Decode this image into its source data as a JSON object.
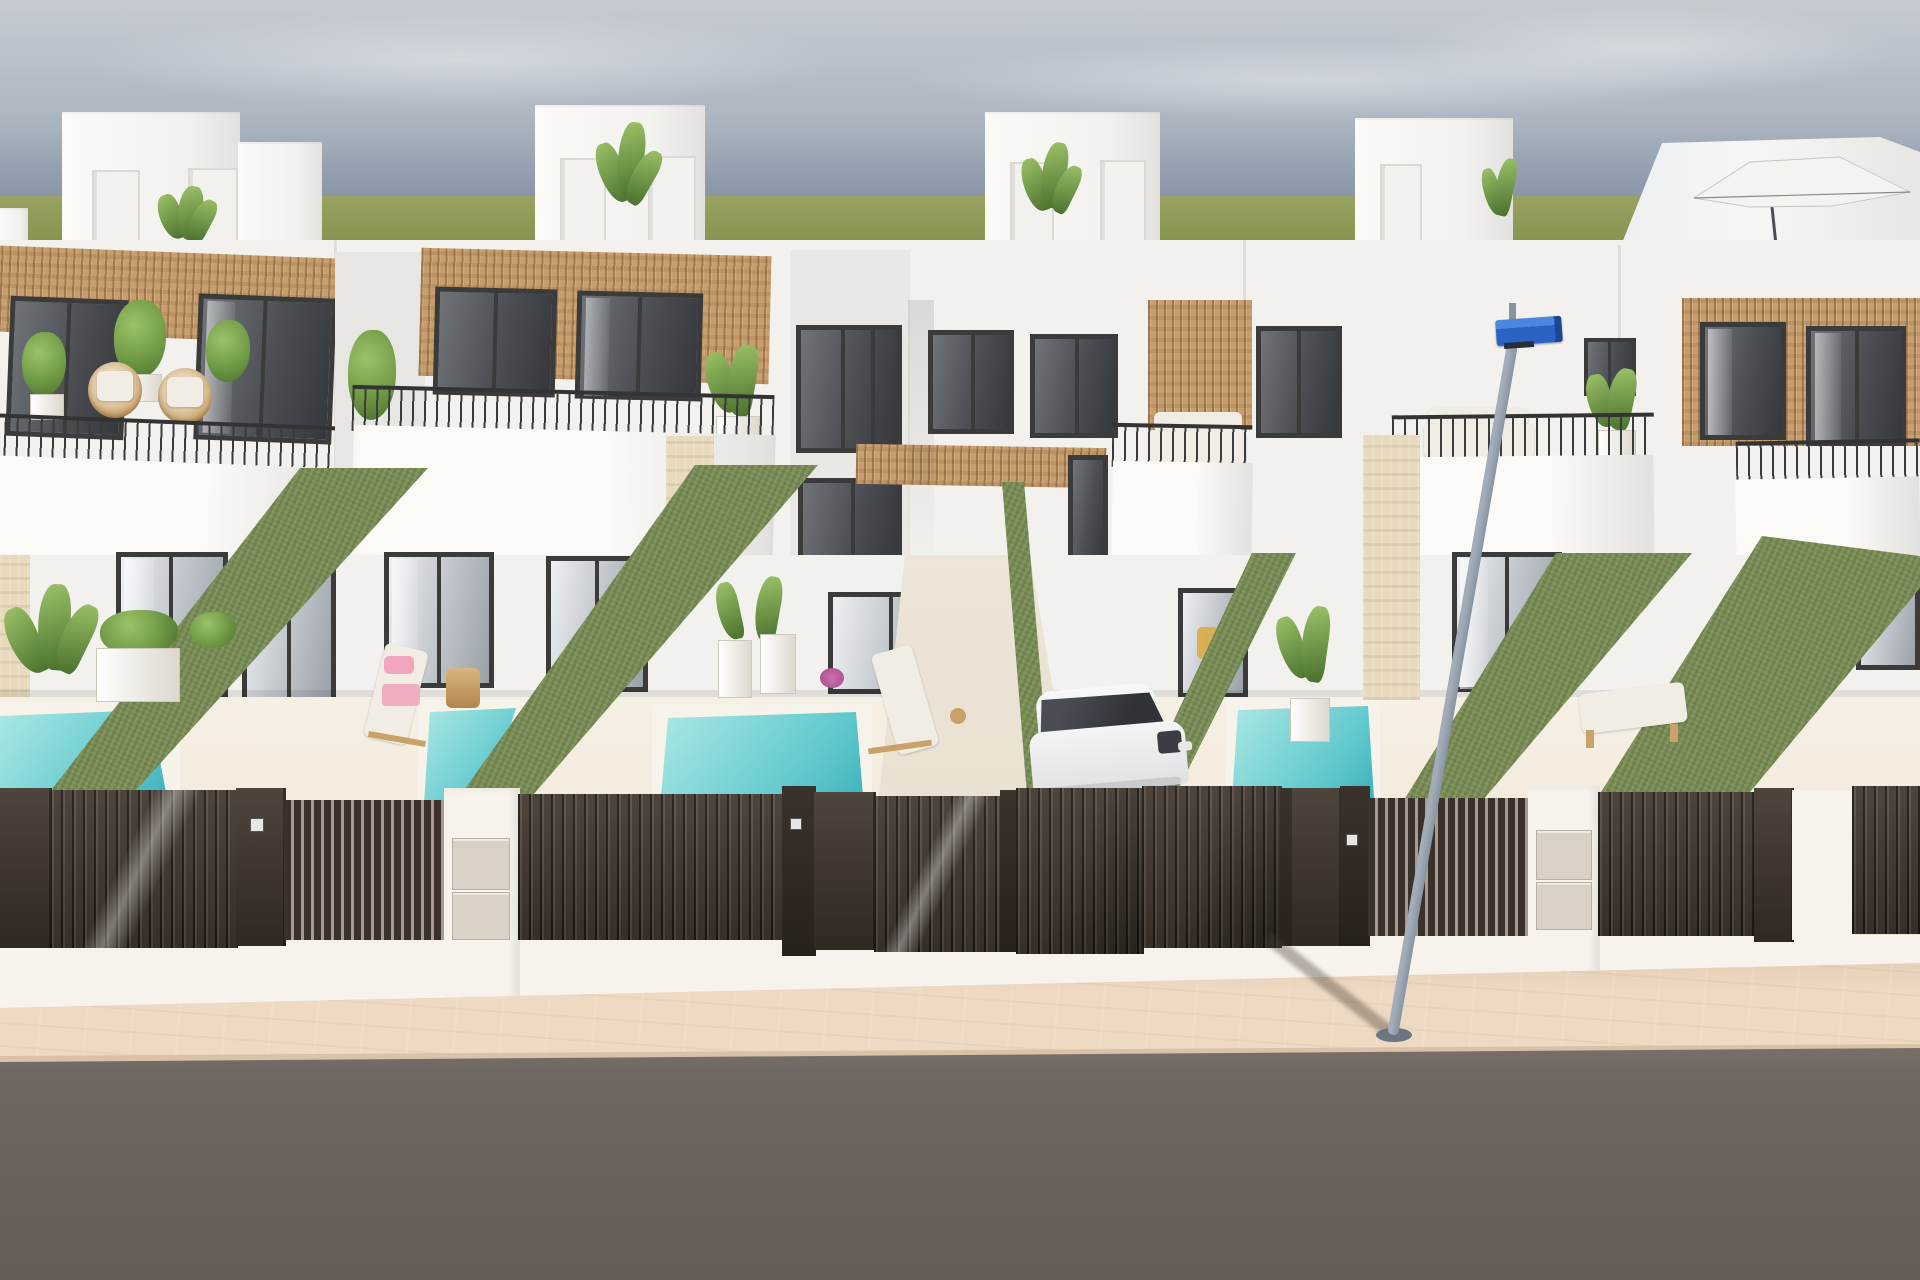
{
  "scene": {
    "type": "architectural-3d-render",
    "description": "Exterior daylight render of a row of modern two-storey white villas with rooftop terraces, wood-slat facade accents, black-framed glazing, private plunge pools, green hedge dividers, dark slatted entrance gates with white masonry piers, a parked white car, a blue-headed street lamp, a beige paved sidewalk and a grey asphalt road under a hazy blue-grey sky with a flat green horizon.",
    "environment": {
      "sky": "hazy gradient, soft clouds",
      "horizon": "flat green field",
      "time_of_day": "day"
    }
  },
  "objects": {
    "villas": 4,
    "rooftop_stair_boxes": 4,
    "rooftop_parasol": 1,
    "balconies_with_railings": 5,
    "pools": 4,
    "sun_loungers": 3,
    "hedge_dividers": 6,
    "slatted_gates_and_fences": 12,
    "utility_box_piers": 2,
    "street_lamp": 1,
    "parked_car": 1,
    "stone_piers": 3
  },
  "palette": {
    "sky_top": "#c6cbd0",
    "sky_mid": "#aeb8c3",
    "sky_low": "#8b98a9",
    "grass": "#99a263",
    "grass_dark": "#86944f",
    "wall": "#f2f1ee",
    "wall_hi": "#fbfaf7",
    "wall_sh": "#e2e1de",
    "frame": "#3b3b3b",
    "glass_hi": "#eef0f1",
    "glass_mid": "#c6cbd0",
    "glass_lo": "#9aa1a8",
    "wood": "#c79e6e",
    "hedge": "#7b8f56",
    "pool_hi": "#abe8e4",
    "pool_lo": "#5fc8cd",
    "pool_dk": "#3fb0bb",
    "white_wall": "#f7f3ec",
    "stone": "#e8dabd",
    "utilbox": "#d9d1c5",
    "sidewalk": "#eed9c3",
    "sidewalk_dk": "#e0c8ae",
    "curb": "#d9c2a7",
    "road": "#6f6761",
    "road_dk": "#645c56",
    "lamp_blue": "#2a63c4",
    "lamp_blue_hi": "#4b86e0",
    "lamp_blue_dk": "#1c478f",
    "pole": "#a2adb9",
    "pole_dk": "#8793a0",
    "cushion": "#f1ede4",
    "rattan": "#c9a169",
    "towel_pink": "#f2a6bd",
    "flower_pink": "#cc6fae",
    "plant": "#6f9a44",
    "plant_dk": "#49702d",
    "plant_hi": "#9cc268"
  }
}
